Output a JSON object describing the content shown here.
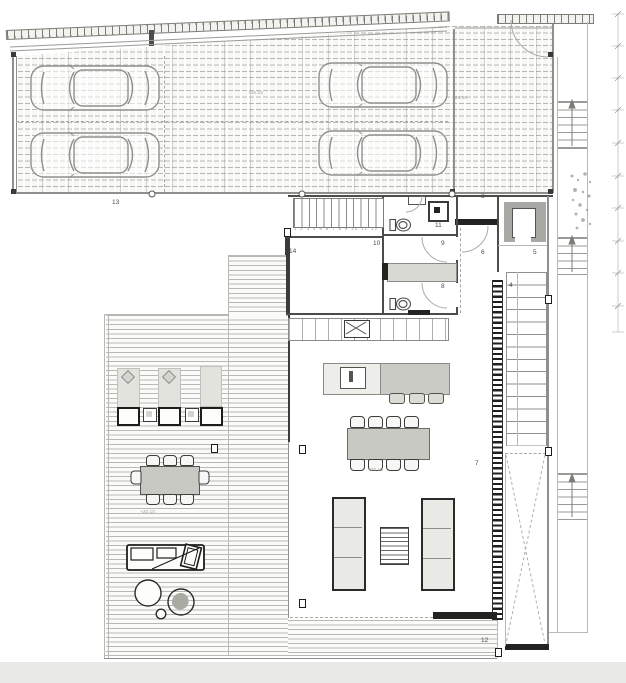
{
  "plan": {
    "type": "architectural floor plan, upper level with carport and deck"
  },
  "rooms": [
    {
      "id": "carport-area",
      "label": "13"
    },
    {
      "id": "enclosed-garage",
      "label": "3"
    },
    {
      "id": "entry-hall",
      "label": "6"
    },
    {
      "id": "elevator",
      "label": "5"
    },
    {
      "id": "staircase",
      "label": "4"
    },
    {
      "id": "bathroom-north",
      "label": "11"
    },
    {
      "id": "hallway",
      "label": "9"
    },
    {
      "id": "bedroom",
      "label": "10"
    },
    {
      "id": "bathroom-south",
      "label": "8"
    },
    {
      "id": "closet",
      "label": "14"
    },
    {
      "id": "living-room",
      "label": "7"
    },
    {
      "id": "deck-walkway",
      "label": "12"
    }
  ],
  "levels": [
    {
      "id": "carport-level",
      "text": "+26.15"
    },
    {
      "id": "garage-level",
      "text": "+26.15"
    },
    {
      "id": "terrace-level",
      "text": "+20.10"
    },
    {
      "id": "living-level",
      "text": "+20.15"
    }
  ],
  "wardrobe": {
    "numbers_text": "1 2 3 4 5 6 7 8 9 10 11 12"
  },
  "colors": {
    "wall": "#4c4c4a",
    "heavy_wall": "#232321",
    "line": "#8f8f8b",
    "furniture_fill": "#ccccc7",
    "deck_stripe": "#767671",
    "page_strip": "#e9e9e7"
  }
}
